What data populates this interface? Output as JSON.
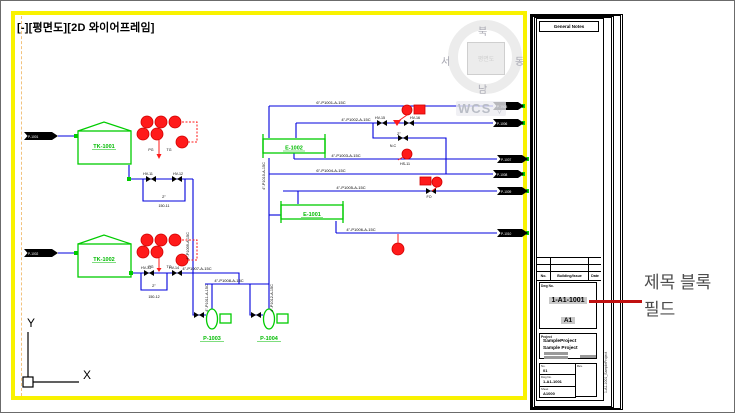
{
  "window": {
    "bg": "#ffffff",
    "border": "#6b6b6b"
  },
  "viewport": {
    "label": "[-][평면도][2D 와이어프레임]",
    "frame_color": "#f9f200",
    "margin_color": "#f2c27e"
  },
  "viewcube": {
    "north": "북",
    "west": "서",
    "east": "동",
    "south": "남",
    "face_label": "평면도",
    "wcs_label": "WCS",
    "wcs_arrow": "▽"
  },
  "ucs": {
    "x_label": "X",
    "y_label": "Y"
  },
  "annotation": {
    "line1": "제목 블록",
    "line2": "필드",
    "text_color": "#4c4c4c",
    "leader_color": "#c01010"
  },
  "title_block": {
    "header": "General Notes",
    "rev_table": {
      "col_no": "No.",
      "col_mid": "Building/Issue",
      "col_date": "Date"
    },
    "dwg_label": "Dwg No.",
    "sheet_no": "1-A1-1001",
    "sheet_size": "A1",
    "highlight_color": "#c8c8c8",
    "project_label": "Project",
    "project_name1": "SampleProject",
    "project_name2": "Sample Project",
    "fields": [
      {
        "label": "No.",
        "value": "01"
      },
      {
        "label": "Dwg No.",
        "value": "1-A1-1001"
      },
      {
        "label": "Sheet",
        "value": "A1000"
      }
    ],
    "rev_label": "Rev.",
    "side_text": "1-A1-1001_SampleProject"
  },
  "diagram": {
    "colors": {
      "pipe": "#0000dd",
      "equipment": "#00cc00",
      "instrument": "#ff1a1a"
    },
    "equipment": {
      "tank1": "TK-1001",
      "tank2": "TK-1002",
      "vessel1": "E-1002",
      "vessel2": "E-1001",
      "pump1": "P-1003",
      "pump2": "P-1004"
    },
    "connectors": {
      "in": [
        "P-1001",
        "P-1002"
      ],
      "out": [
        "P-1005",
        "P-1006",
        "P-1007",
        "P-1008",
        "P-1009",
        "P-1010"
      ]
    },
    "pipe_labels": [
      "6\"-P1001-A-15C",
      "4\"-P1002-A-15C",
      "4\"-P1003-A-15C",
      "6\"-P1004-A-15C",
      "4\"-P1005-A-15C",
      "4\"-P1006-A-15C",
      "4\"-P1007-A-15C",
      "4\"-P1008-A-15C",
      "4\"-P1009-A-15C",
      "4\"-P1010-A-15C",
      "4\"-P1011-A-15C",
      "4\"-P1012-A-15C"
    ],
    "size_labels": [
      "2\"",
      "2\"",
      "2\""
    ],
    "valve_labels": [
      "HV-11",
      "HV-12",
      "HV-13",
      "HV-14",
      "HV-15",
      "HV-16"
    ],
    "inst_labels": [
      "PG",
      "TG",
      "PG",
      "TG"
    ],
    "misc_labels": [
      "150-11",
      "150-12",
      "FO",
      "N.C",
      "HS-11"
    ]
  }
}
